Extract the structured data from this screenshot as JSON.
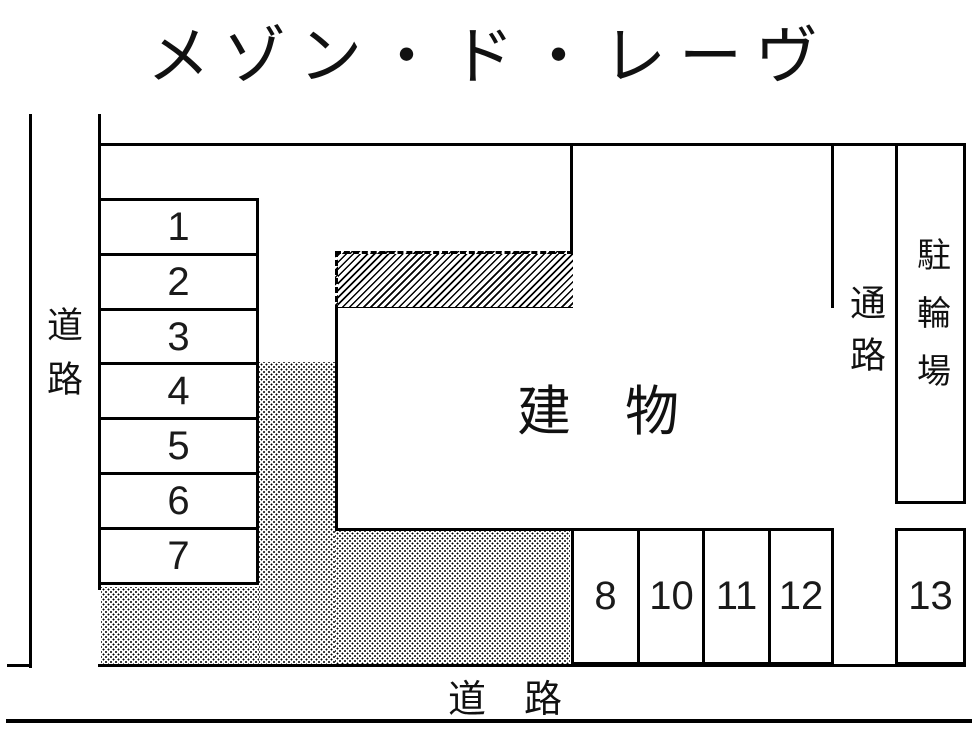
{
  "title": "メゾン・ド・レーヴ",
  "roads": {
    "left_label": "道路",
    "bottom_label": "道　路"
  },
  "building": {
    "label": "建　物"
  },
  "aisle": {
    "label": "通路"
  },
  "bicycle_parking": {
    "label": "駐輪場"
  },
  "parking": {
    "left_column": [
      "1",
      "2",
      "3",
      "4",
      "5",
      "6",
      "7"
    ],
    "bottom_row": [
      "8",
      "10",
      "11",
      "12"
    ],
    "right_space": "13"
  },
  "colors": {
    "line": "#000000",
    "background": "#ffffff"
  }
}
